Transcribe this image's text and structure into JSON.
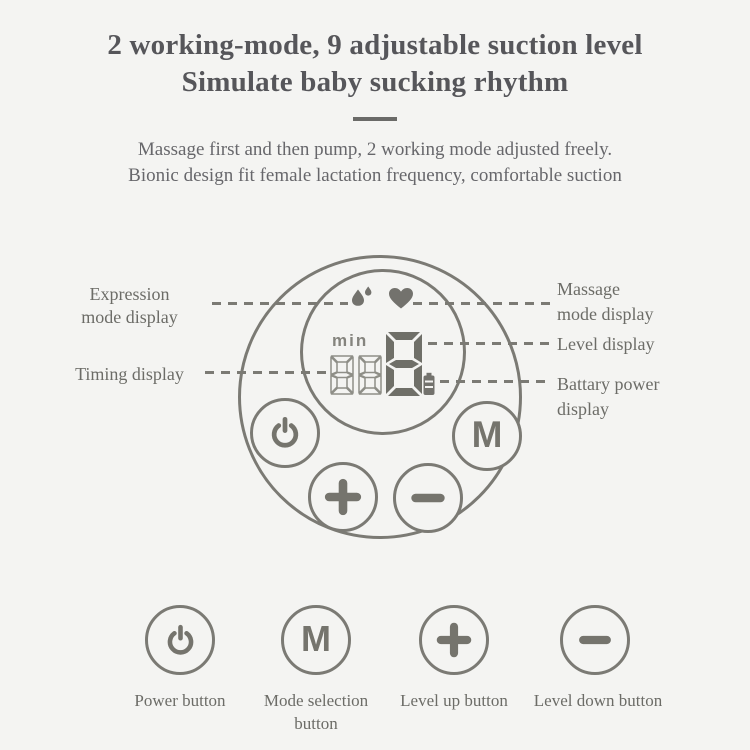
{
  "header": {
    "title_line1": "2 working-mode, 9 adjustable suction level",
    "title_line2": "Simulate baby sucking rhythm",
    "subtitle_line1": "Massage first and then pump, 2 working mode adjusted freely.",
    "subtitle_line2": "Bionic design fit female lactation frequency, comfortable suction"
  },
  "device": {
    "display": {
      "min_label": "min",
      "timer_value": "88",
      "level_value": "8",
      "expression_icon": "water-drops-icon",
      "massage_icon": "heart-icon",
      "battery_icon": "battery-icon"
    },
    "buttons": {
      "power_icon": "power-icon",
      "mode_label": "M",
      "level_up_icon": "plus-icon",
      "level_down_icon": "minus-icon"
    }
  },
  "callouts": {
    "expression": {
      "line1": "Expression",
      "line2": "mode display"
    },
    "massage": {
      "line1": "Massage",
      "line2": "mode display"
    },
    "level": {
      "label": "Level display"
    },
    "timing": {
      "label": "Timing display"
    },
    "battery": {
      "line1": "Battary power",
      "line2": "display"
    }
  },
  "legend": {
    "items": [
      {
        "icon": "power-icon",
        "line1": "Power button"
      },
      {
        "icon": "mode-icon",
        "line1": "Mode selection",
        "line2": "button"
      },
      {
        "icon": "plus-icon",
        "line1": "Level up button"
      },
      {
        "icon": "minus-icon",
        "line1": "Level down button"
      }
    ]
  },
  "colors": {
    "background": "#f4f4f2",
    "title_text": "#56565a",
    "subtitle_text": "#67676b",
    "label_text": "#6c6c67",
    "device_line": "#7b7a74",
    "segment_filled": "#6f6f68",
    "segment_outline": "#8e8e87"
  }
}
